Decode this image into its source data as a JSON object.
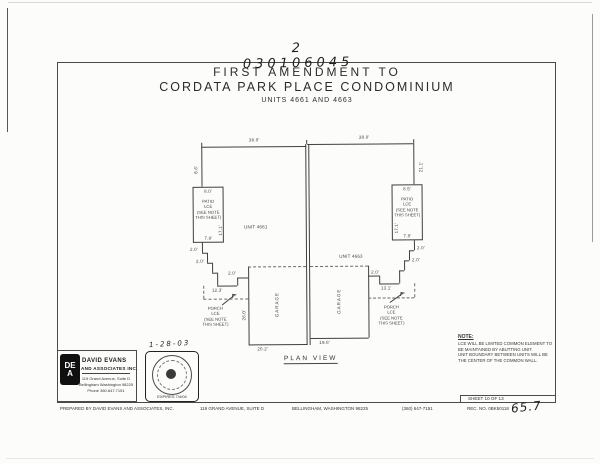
{
  "scan": {
    "recording_number": "2 030106045",
    "title_line1": "FIRST AMENDMENT TO",
    "title_line2": "CORDATA PARK PLACE CONDOMINIUM",
    "title_line3": "UNITS 4661 AND 4663"
  },
  "plan": {
    "view_label": "PLAN VIEW",
    "unit_left": "UNIT 4661",
    "unit_right": "UNIT 4663",
    "garage_label": "GARAGE",
    "patio": {
      "l1": "PATIO",
      "l2": "LCE",
      "l3": "(SEE NOTE",
      "l4": "THIS SHEET)"
    },
    "porch": {
      "l1": "PORCH",
      "l2": "LCE",
      "l3": "(SEE NOTE",
      "l4": "THIS SHEET)"
    },
    "dims": {
      "top_left": "38.0'",
      "top_right": "38.0'",
      "left_wall": "8.6'",
      "right_wall": "21.1'",
      "patio_left_top": "8.0'",
      "patio_left_bottom": "7.8'",
      "patio_left_side": "17.1'",
      "patio_right_top": "8.5'",
      "patio_right_bottom": "7.8'",
      "patio_right_side": "17.1'",
      "step": "2.0'",
      "left_run": "12.3'",
      "right_run": "13.1'",
      "garage_left_width": "20.2'",
      "garage_right_width": "19.8'",
      "garage_depth": "26.0'"
    }
  },
  "note": {
    "heading": "NOTE:",
    "lines": [
      "LCE WILL BE LIMITED COMMON ELEMENT TO",
      "BE MAINTAINED BY ABUTTING UNIT.",
      "UNIT BOUNDARY BETWEEN UNITS WILL BE",
      "THE CENTER OF THE COMMON WALL."
    ]
  },
  "firm": {
    "logo_top": "DE",
    "logo_bottom": "A",
    "name1": "DAVID EVANS",
    "name2": "AND ASSOCIATES INC.",
    "addr1": "119 Grand Avenue, Suite D",
    "addr2": "Bellingham Washington 98225",
    "addr3": "Phone  360.647.7151"
  },
  "stamp": {
    "date": "1-28-03",
    "expires": "EXPIRES  7/4/04"
  },
  "footer": {
    "prepared": "PREPARED BY DAVID EVANS AND ASSOCIATES, INC.",
    "address": "119 GRAND AVENUE, SUITE D",
    "city": "BELLINGHAM, WASHINGTON  98225",
    "phone": "(360) 647-7151",
    "sheet": "SHEET  10  OF  13",
    "rec": "REC. NO.  0BK50118",
    "handwritten_page": "65.7"
  }
}
